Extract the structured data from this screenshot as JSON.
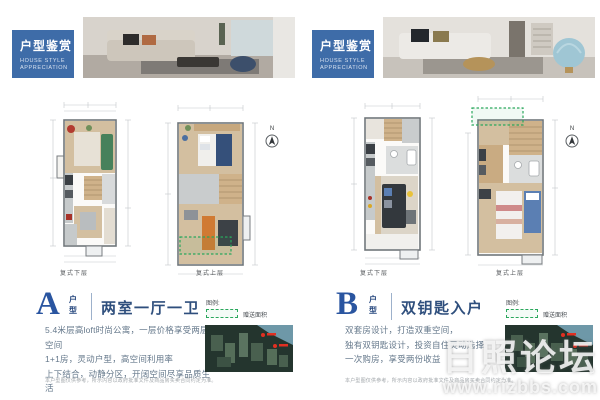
{
  "panels": [
    {
      "id": "A",
      "header": {
        "title_cn": "户型鉴赏",
        "title_en_line1": "HOUSE STYLE",
        "title_en_line2": "APPRECIATION"
      },
      "plan_labels": {
        "lower": "复式下层",
        "upper": "复式上层"
      },
      "north_label": "N",
      "type_letter": "A",
      "type_suffix_top": "户",
      "type_suffix_bottom": "型",
      "headline": "两室一厅一卫",
      "body_lines": {
        "line1": "5.4米层高loft时尚公寓，一层价格享受两层空间",
        "line2": "1+1房，灵动户型，高空间利用率",
        "line3": "上下结合，动静分区，开阔空间尽享品质生活"
      },
      "legend": {
        "label": "图例:",
        "item": "赠送面积"
      },
      "disclaimer": "本户型图仅供参考，所示内容以政府批准文件及商品房买卖合同约定为准。"
    },
    {
      "id": "B",
      "header": {
        "title_cn": "户型鉴赏",
        "title_en_line1": "HOUSE STYLE",
        "title_en_line2": "APPRECIATION"
      },
      "plan_labels": {
        "lower": "复式下层",
        "upper": "复式上层"
      },
      "north_label": "N",
      "type_letter": "B",
      "type_suffix_top": "户",
      "type_suffix_bottom": "型",
      "headline": "双钥匙入户",
      "body_lines": {
        "line1": "双套房设计，打造双重空间，",
        "line2": "独有双钥匙设计，投资自住灵动选择",
        "line3": "一次购房，享受两份收益"
      },
      "legend": {
        "label": "图例:",
        "item": "赠送面积"
      },
      "disclaimer": "本户型图仅供参考，所示内容以政府批准文件及商品房买卖合同约定为准。"
    }
  ],
  "watermark": {
    "line1": "日照论坛",
    "line2": "www.rizbbs.com"
  },
  "colors": {
    "header_blue": "#3e6ca8",
    "navy_letter": "#2a55a0",
    "headline_navy": "#2f4f7d",
    "gift_green": "#2aa75c"
  }
}
